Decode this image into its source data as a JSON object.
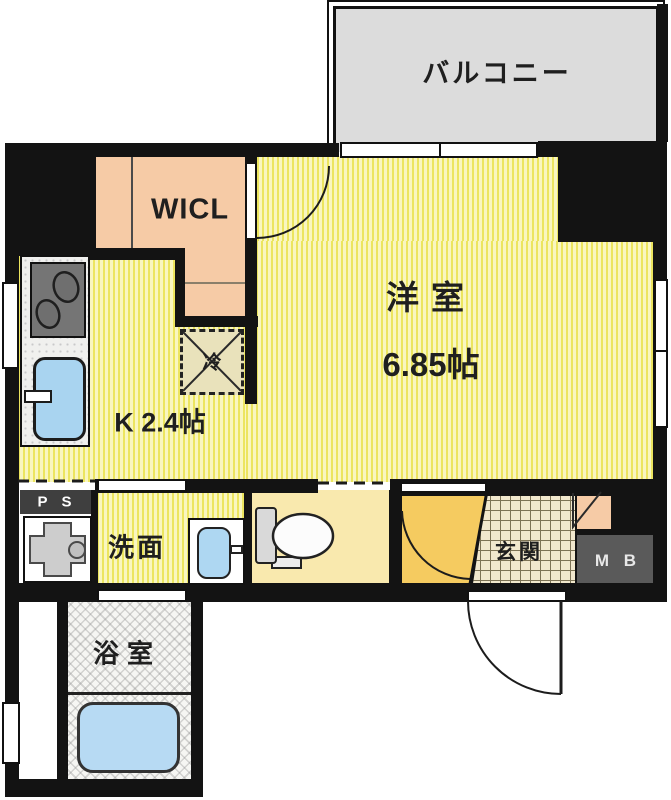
{
  "title": "apartment-floor-plan",
  "rooms": {
    "balcony": {
      "label": "バルコニー"
    },
    "wicl": {
      "label": "WICL"
    },
    "western_room": {
      "label": "洋室",
      "size": "6.85帖"
    },
    "kitchen": {
      "label": "K 2.4帖"
    },
    "refrigerator_space": {
      "label": "冷"
    },
    "pipe_space": {
      "label": "P S"
    },
    "washroom": {
      "label": "洗面"
    },
    "entrance": {
      "label": "玄関"
    },
    "meter_box": {
      "label": "M B"
    },
    "bathroom": {
      "label": "浴室"
    }
  },
  "colors": {
    "wall": "#131313",
    "floor_stripe_dark": "#ece55f",
    "floor_stripe_light": "#f9f6c0",
    "closet_pink": "#f6cba6",
    "balcony_gray": "#dcdcdc",
    "toilet_room_cream": "#f9e9ae",
    "hall_amber": "#f5cb60",
    "entrance_tile": "#f1e8cd",
    "water_blue": "#a9d4f0",
    "meter_box_gray": "#5a5a5a"
  }
}
